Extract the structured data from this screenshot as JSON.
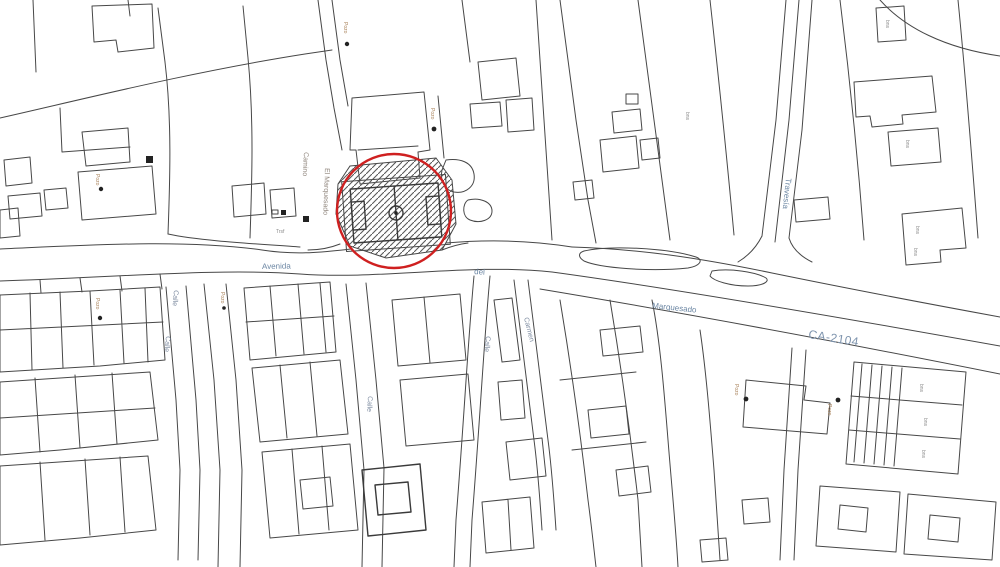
{
  "map": {
    "description": "Cadastral street map with a red circle highlighting a hatched sports-field parcel",
    "colors": {
      "background": "#ffffff",
      "parcel_lines": "#474747",
      "road_label": "#6b86a3",
      "street_label": "#7d8ba0",
      "poi_label": "#a9825a",
      "code_label": "#8c8c8c",
      "highlight_red": "#cf2020",
      "hatch": "#5a5a5a"
    },
    "road_labels": {
      "avenida": "Avenida",
      "del": "del",
      "marquesado": "Marquesado",
      "ca_2104": "CA-2104",
      "travesia": "Travesía"
    },
    "street_labels": {
      "camino": "Camino",
      "el_marquesado": "El Marquesado",
      "calle": "Calle",
      "carmen": "Carmen"
    },
    "poi_labels": {
      "pozo": "Pozo",
      "trsf": "Trsf",
      "bns": "bns"
    },
    "highlight": {
      "shape": "circle",
      "center_x": 394,
      "center_y": 211,
      "radius": 57,
      "feature": "football-field-parcel-hatched"
    }
  }
}
